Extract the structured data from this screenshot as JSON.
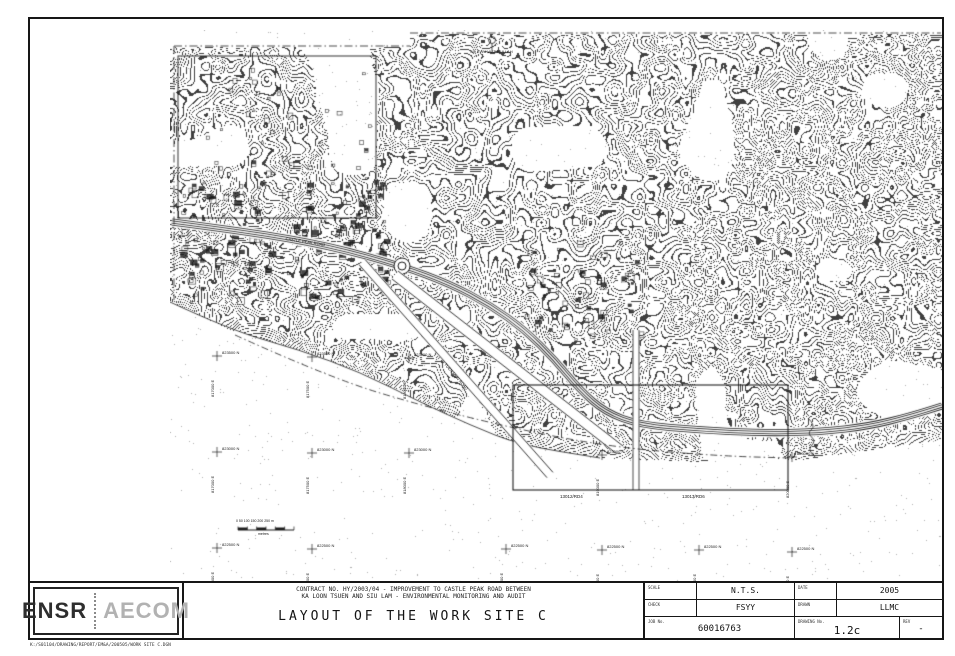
{
  "sheet": {
    "file_path": "K:/S01104/DRAWING/REPORT/EM&A/200505/WORK SITE C.DGN"
  },
  "title_block": {
    "logo_ensr": "ENSR",
    "logo_aecom": "AECOM",
    "contract_line1": "CONTRACT NO. HY/2003/04 - IMPROVEMENT TO CASTLE PEAK ROAD BETWEEN",
    "contract_line2": "KA LOON TSUEN AND SIU LAM - ENVIRONMENTAL MONITORING AND AUDIT",
    "drawing_title": "LAYOUT OF THE WORK SITE C",
    "scale_label": "SCALE",
    "scale_value": "N.T.S.",
    "date_label": "DATE",
    "date_value": "2005",
    "check_label": "CHECK",
    "check_value": "FSYY",
    "drawn_label": "DRAWN",
    "drawn_value": "LLMC",
    "job_no_label": "JOB No.",
    "job_no_value": "60016763",
    "drawing_no_label": "DRAWING No.",
    "drawing_no_value": "1.2c",
    "rev_label": "REV",
    "rev_value": "-"
  },
  "map": {
    "ink_color": "#1c1c1c",
    "labels": [
      {
        "name": "label-so-kwu-wat-nullah",
        "text": "SO KWU WAT NULLAH",
        "x": 470,
        "y": 49,
        "size": 4,
        "rot": 0
      },
      {
        "name": "label-castle-peak-road",
        "text": "CASTLE PEAK ROAD",
        "x": 286,
        "y": 236,
        "size": 4,
        "rot": 9
      },
      {
        "name": "label-tuen-mun-road",
        "text": "TUEN MUN ROAD",
        "x": 447,
        "y": 362,
        "size": 4,
        "rot": 49
      },
      {
        "name": "label-worksite-ref-1",
        "text": "13012/RD4",
        "x": 560,
        "y": 494,
        "size": 4.5,
        "rot": 0
      },
      {
        "name": "label-worksite-ref-2",
        "text": "13013/RD6",
        "x": 682,
        "y": 494,
        "size": 4.5,
        "rot": 0
      },
      {
        "name": "label-point-b",
        "text": "B'",
        "x": 190,
        "y": 300,
        "size": 4.5,
        "rot": 0
      },
      {
        "name": "label-scale-bar-numbers",
        "text": "0  50  100  150  200  250 m",
        "x": 236,
        "y": 519,
        "size": 3.5,
        "rot": 0
      },
      {
        "name": "label-scale-bar-caption",
        "text": "metres",
        "x": 258,
        "y": 532,
        "size": 3.5,
        "rot": 0
      }
    ],
    "grid_crosses": [
      {
        "x": 217,
        "y": 356,
        "n": "823500 N",
        "e": "817000 E"
      },
      {
        "x": 312,
        "y": 357,
        "n": "823500 N",
        "e": "817500 E"
      },
      {
        "x": 409,
        "y": 358,
        "n": "823500 N",
        "e": "818000 E"
      },
      {
        "x": 217,
        "y": 452,
        "n": "823000 N",
        "e": "817000 E"
      },
      {
        "x": 312,
        "y": 453,
        "n": "823000 N",
        "e": "817500 E"
      },
      {
        "x": 409,
        "y": 453,
        "n": "823000 N",
        "e": "818000 E"
      },
      {
        "x": 602,
        "y": 455,
        "n": "823000 N",
        "e": "819000 E"
      },
      {
        "x": 792,
        "y": 457,
        "n": "823000 N",
        "e": "820000 E"
      },
      {
        "x": 217,
        "y": 548,
        "n": "822500 N",
        "e": "817000 E"
      },
      {
        "x": 312,
        "y": 549,
        "n": "822500 N",
        "e": "817500 E"
      },
      {
        "x": 506,
        "y": 549,
        "n": "822500 N",
        "e": "818500 E"
      },
      {
        "x": 602,
        "y": 550,
        "n": "822500 N",
        "e": "819000 E"
      },
      {
        "x": 699,
        "y": 550,
        "n": "822500 N",
        "e": "819500 E"
      },
      {
        "x": 792,
        "y": 552,
        "n": "822500 N",
        "e": "820000 E"
      }
    ]
  }
}
